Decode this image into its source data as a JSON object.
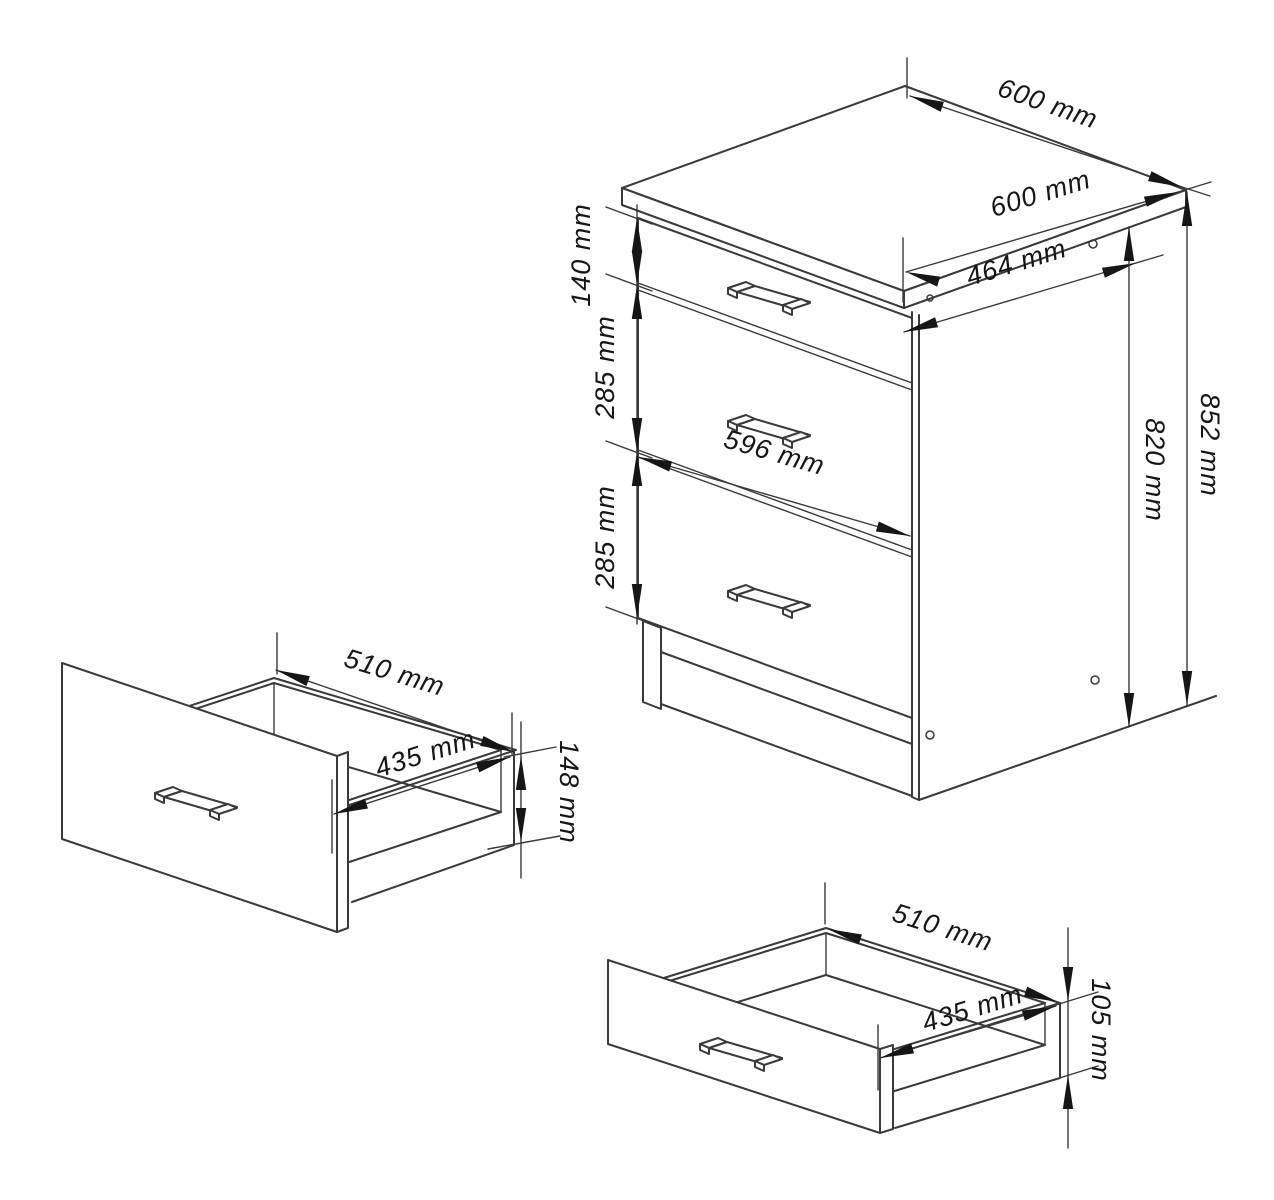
{
  "drawing": {
    "type": "furniture-technical-drawing",
    "units": "mm",
    "colors": {
      "background": "#ffffff",
      "line": "#3a3a3a",
      "text": "#161616"
    },
    "views": {
      "cabinet": {
        "name": "cabinet-isometric-view",
        "dims": {
          "top_depth": "600 mm",
          "top_width": "600 mm",
          "side_panel_depth": "464 mm",
          "top_drawer_front_height": "140 mm",
          "middle_drawer_front_height": "285 mm",
          "bottom_drawer_front_height": "285 mm",
          "front_width": "596 mm",
          "carcass_height": "820 mm",
          "total_height": "852 mm"
        }
      },
      "side_drawer": {
        "name": "drawer-box-side-view",
        "dims": {
          "width": "510 mm",
          "depth": "435 mm",
          "front_height": "148 mm"
        }
      },
      "bottom_drawer": {
        "name": "drawer-box-bottom-view",
        "dims": {
          "width": "510 mm",
          "depth": "435 mm",
          "front_height": "105 mm"
        }
      }
    }
  }
}
